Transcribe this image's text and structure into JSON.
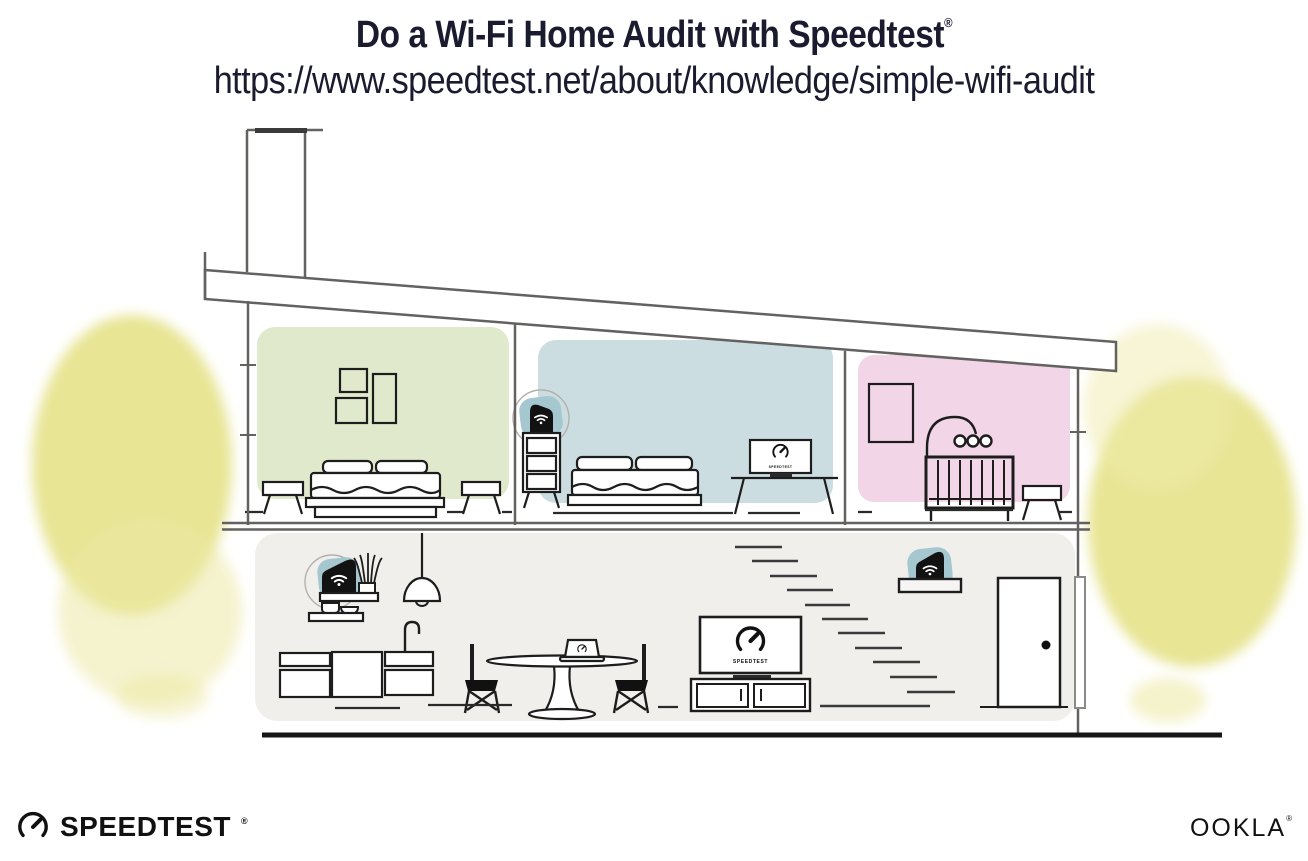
{
  "header": {
    "title": "Do a Wi-Fi Home Audit with Speedtest",
    "registered_mark": "®",
    "url": "https://www.speedtest.net/about/knowledge/simple-wifi-audit"
  },
  "screens": {
    "tv_label": "SPEEDTEST",
    "monitor_label": "SPEEDTEST"
  },
  "footer": {
    "speedtest_wordmark": "SPEEDTEST",
    "speedtest_registered": "®",
    "ookla_wordmark": "OOKLA",
    "ookla_registered": "®"
  },
  "icons": {
    "speedtest-gauge-icon": "open ring with diagonal needle",
    "wifi-icon": "dot with two signal arcs",
    "door-knob-icon": "filled dot"
  },
  "colors": {
    "title_text": "#1a1b2e",
    "structure_line": "#636260",
    "furniture_line": "#1d1d1d",
    "room_green": "#e0e9cb",
    "room_blue": "#ccdde1",
    "room_pink": "#f2d5e6",
    "room_lower_gray": "#f0efec",
    "router_highlight_teal": "#a5c7d0",
    "device_black": "#121212",
    "foliage_yellow": "#e5e288",
    "ground_line": "#161616"
  }
}
